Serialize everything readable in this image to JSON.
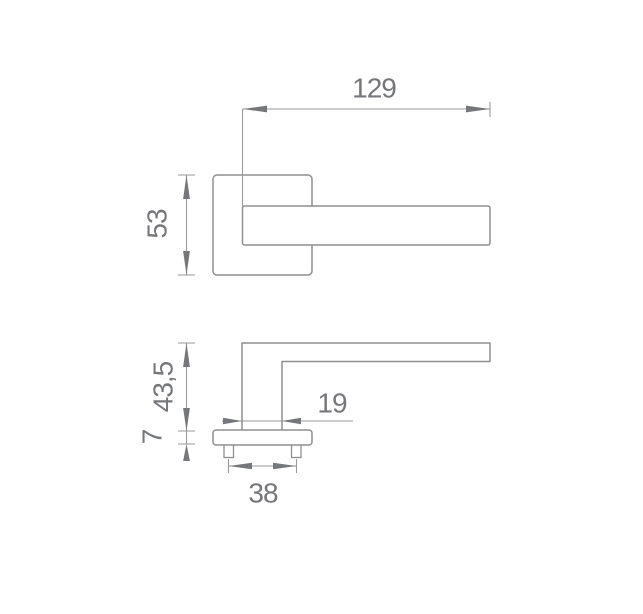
{
  "page": {
    "type": "technical-drawing",
    "subject": "Door handle on square rosette — dimensioned plan and side views",
    "background": "#ffffff"
  },
  "colors": {
    "object_line": "#8f8f8f",
    "dimension_line": "#9a9a9a",
    "arrow_fill": "#76777a",
    "text": "#76777a"
  },
  "views": {
    "top_view": {
      "label": "plan-view",
      "dimensions": {
        "handle_length": "129",
        "rosette_width": "53"
      }
    },
    "side_view": {
      "label": "side-view",
      "dimensions": {
        "handle_height": "43,5",
        "rosette_thickness": "7",
        "grip_depth": "19",
        "screw_spacing": "38"
      }
    }
  }
}
